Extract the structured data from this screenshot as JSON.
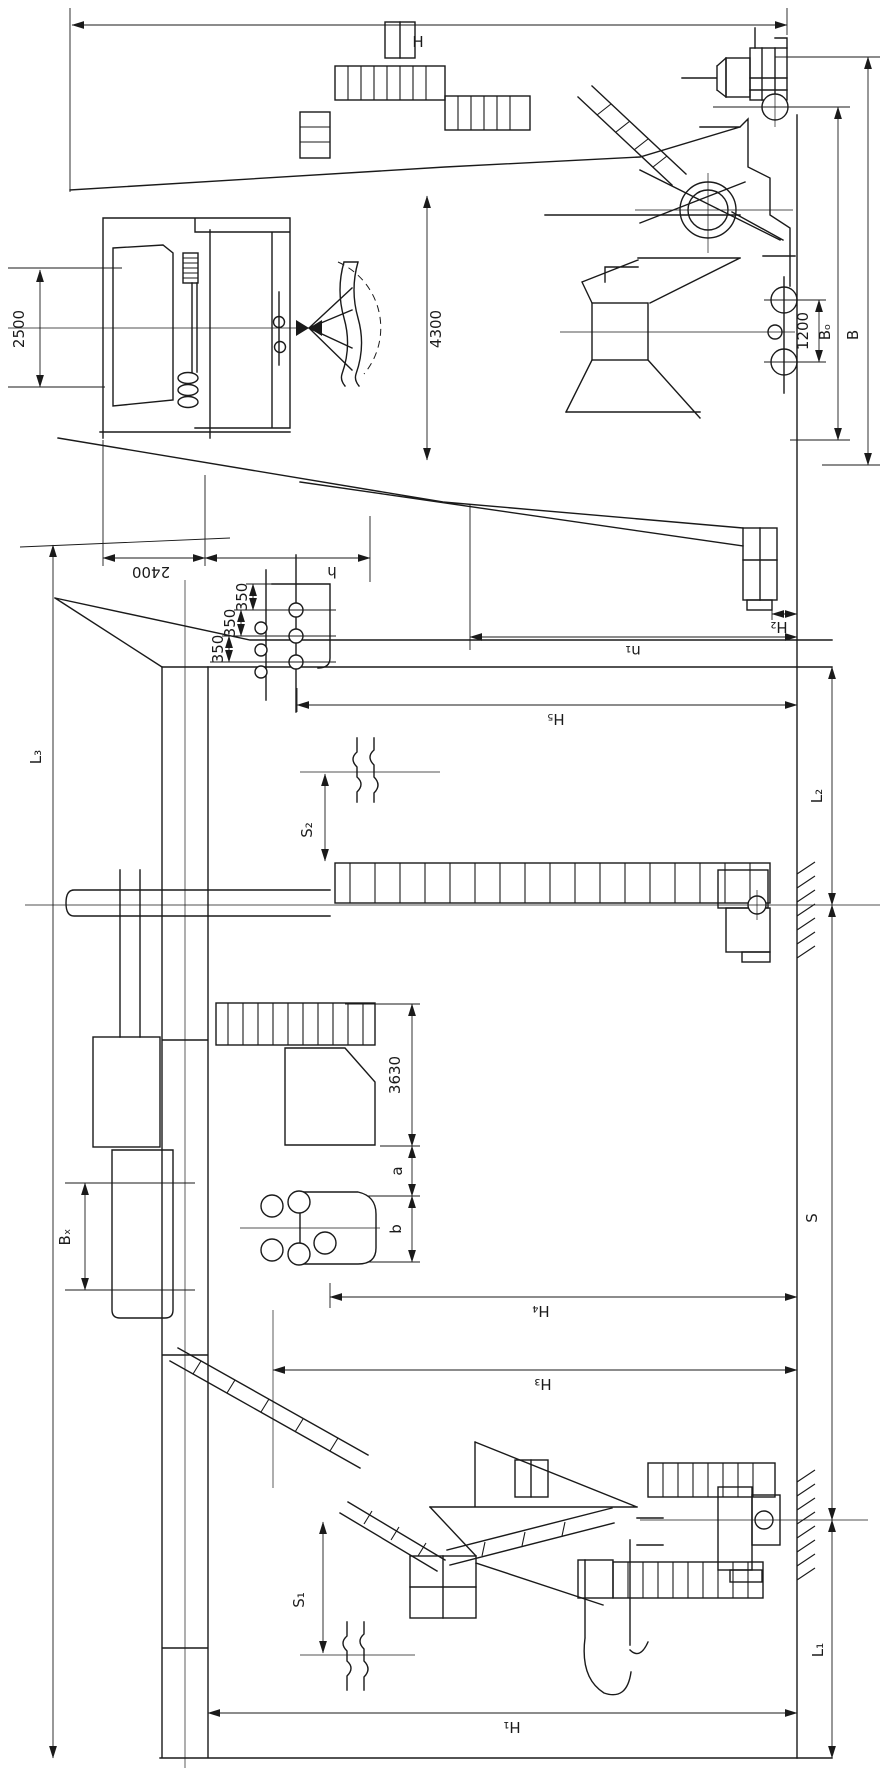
{
  "drawing": {
    "kind": "crane-dimension-diagram",
    "colors": {
      "ink": "#1a1a1a",
      "paper": "#ffffff"
    }
  },
  "labels": {
    "front": {
      "overall_height": "H",
      "house_height": "2500",
      "jib_height": "4300",
      "wheel_base": "1200",
      "gauge_o": "Bₒ",
      "gauge": "B",
      "width_2400": "2400",
      "width_h": "h"
    },
    "side": {
      "pitch_350_1": "350",
      "pitch_350_2": "350",
      "pitch_350_3": "350",
      "l3": "L₃",
      "s2": "S₂",
      "l2": "L₂",
      "h5": "H₅",
      "n1": "n₁",
      "h2": "H₂",
      "bx": "Bₓ",
      "dim_3630": "3630",
      "dim_a": "a",
      "dim_b": "b",
      "span_s": "S",
      "h4": "H₄",
      "h3": "H₃",
      "s1": "S₁",
      "l1": "L₁",
      "h1": "H₁"
    }
  }
}
